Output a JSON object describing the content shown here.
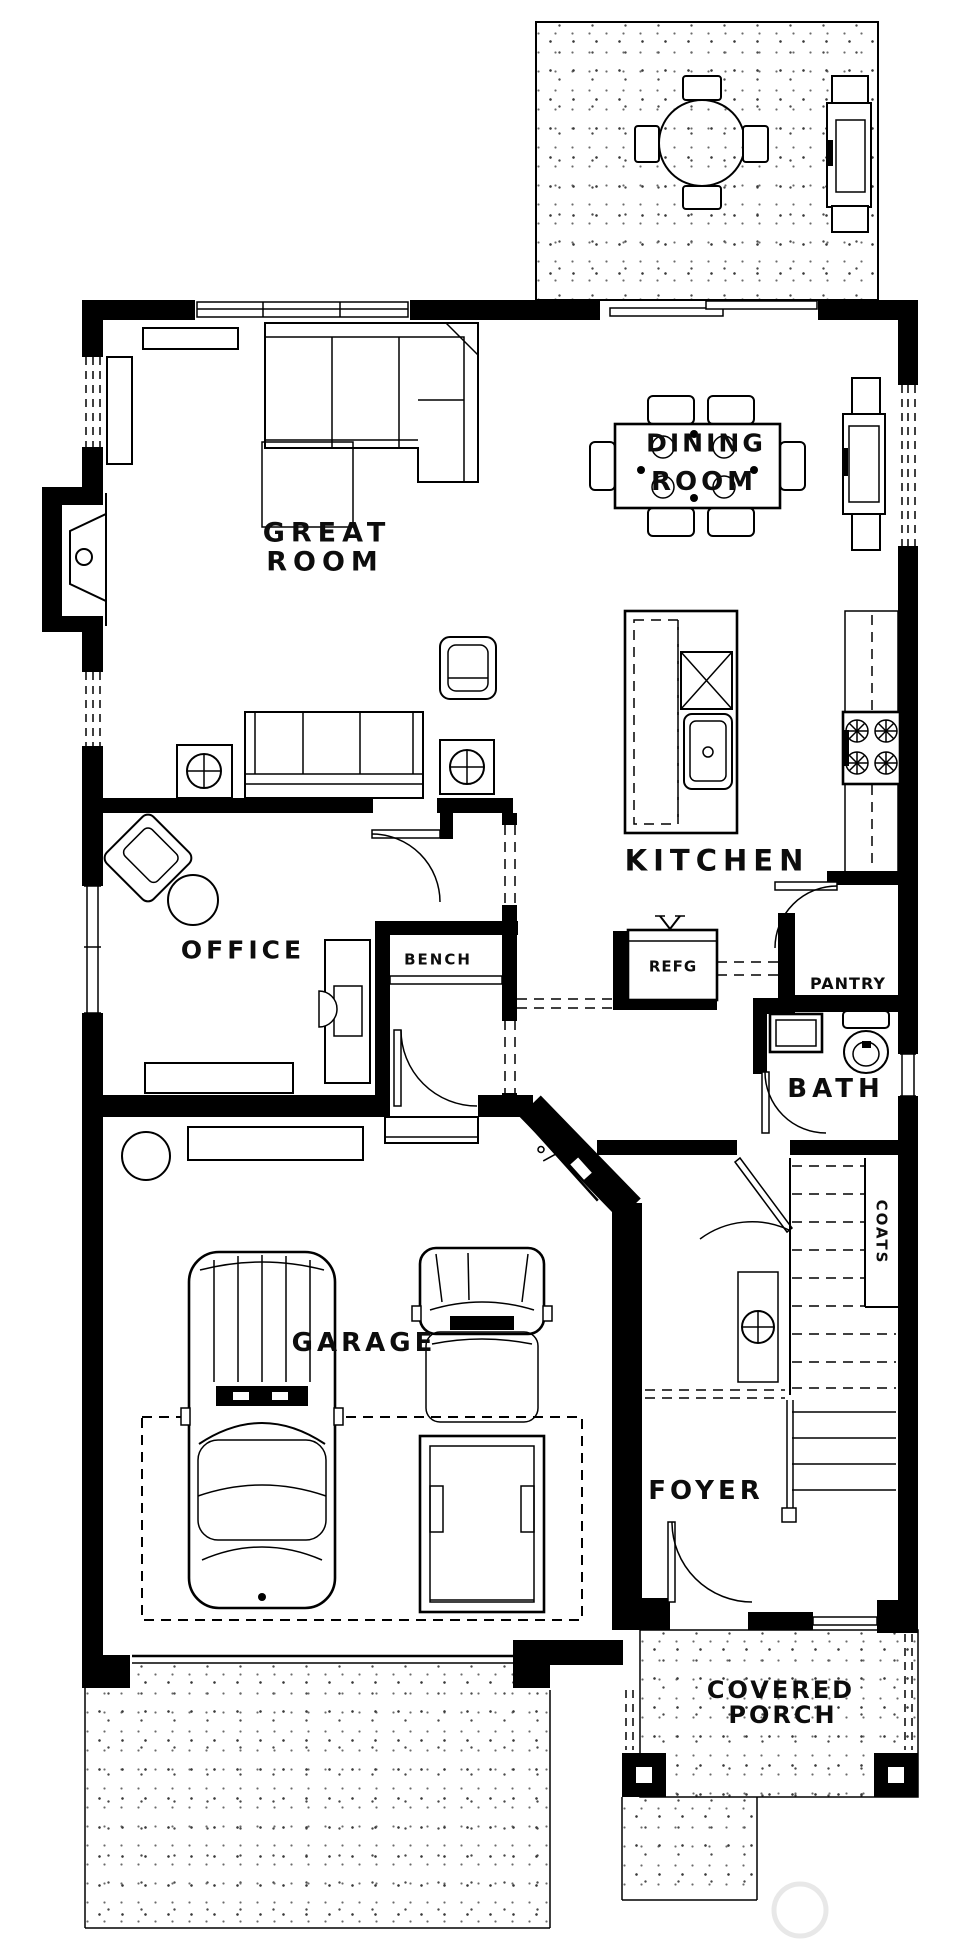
{
  "labels": {
    "great_room": [
      "GREAT",
      "ROOM"
    ],
    "dining_room": [
      "DINING",
      "ROOM"
    ],
    "kitchen": "KITCHEN",
    "office": "OFFICE",
    "bench": "BENCH",
    "refrigerator": "REFG",
    "pantry": "PANTRY",
    "bath": "BATH",
    "coats": "COATS",
    "garage": "GARAGE",
    "foyer": "FOYER",
    "covered_porch": [
      "COVERED",
      "PORCH"
    ]
  },
  "colors": {
    "line": "#000000",
    "background": "#ffffff",
    "stipple_dot": "#4a4a4a",
    "watermark": "#e8e8e8"
  },
  "fixtures": [
    "patio table with four chairs",
    "grill",
    "fireplace",
    "sectional sofa",
    "ottoman",
    "console shelf",
    "bookshelf",
    "armchair",
    "sofa with end-table lamps",
    "dining table for six",
    "buffet hutch",
    "kitchen island with sink and dishwasher",
    "cooktop counter",
    "refrigerator",
    "pantry",
    "bench seat",
    "desk and chair",
    "corner chair with round table",
    "toilet",
    "bath sink",
    "staircase",
    "coat closet",
    "newel post",
    "sedan",
    "pickup truck",
    "workbench",
    "garage door",
    "covered porch posts",
    "driveway",
    "walkway",
    "rear patio"
  ]
}
